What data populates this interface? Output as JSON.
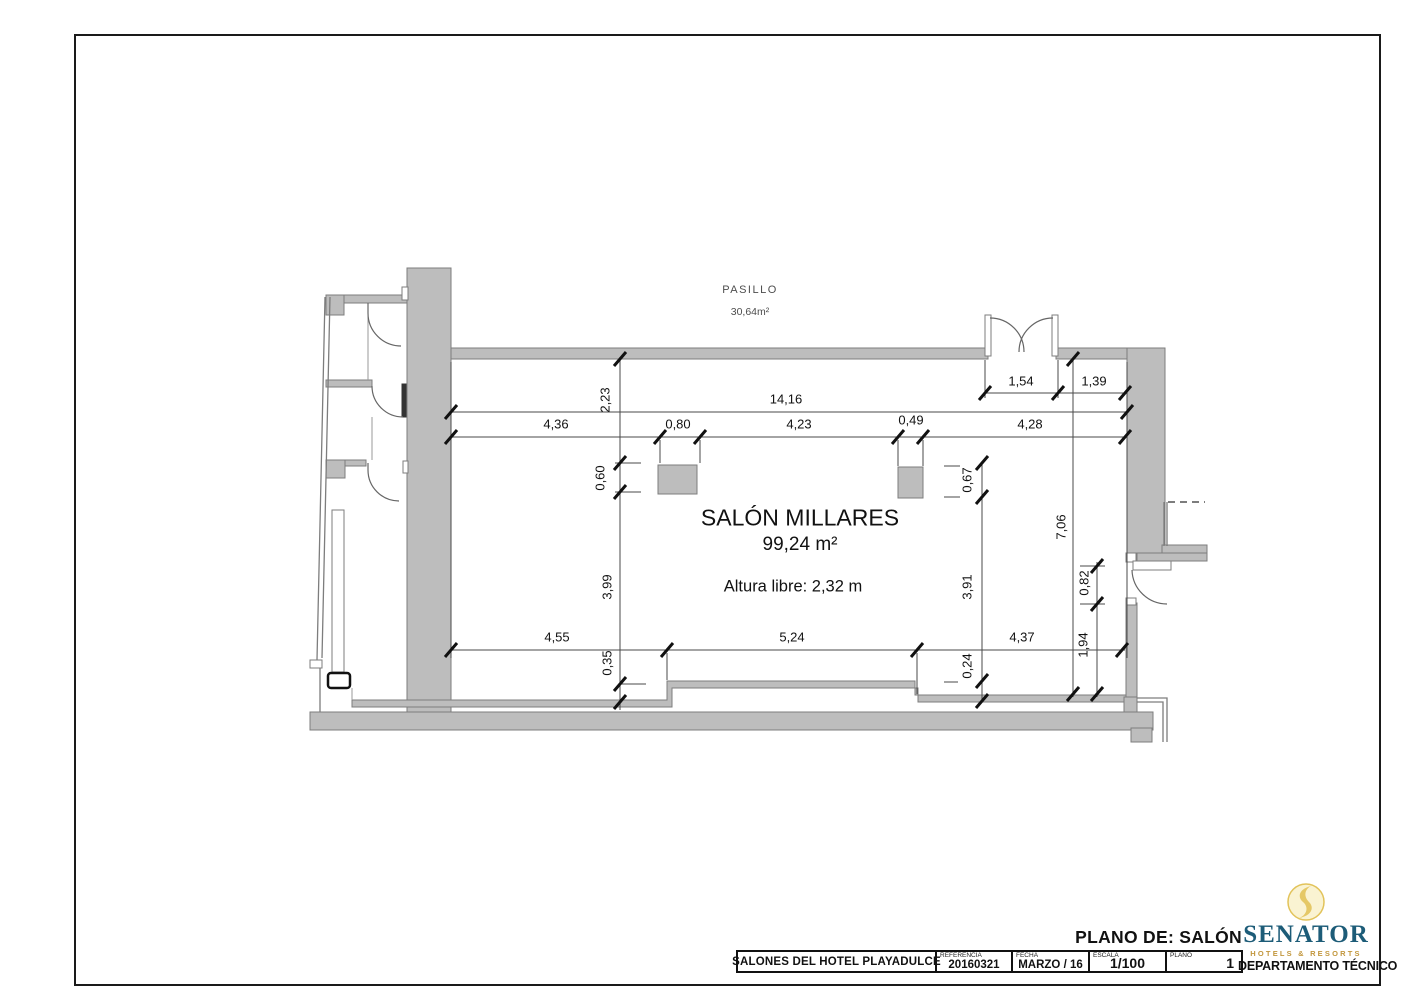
{
  "plan": {
    "corridor": {
      "label": "PASILLO",
      "area": "30,64m²"
    },
    "room": {
      "name": "SALÓN MILLARES",
      "area": "99,24 m²",
      "clear_height": "Altura libre: 2,32 m"
    },
    "dims": {
      "top_overall": "14,16",
      "top_door": "1,54",
      "top_door_right": "1,39",
      "top_left_seg": "4,36",
      "col_left_w": "0,80",
      "top_mid_seg": "4,23",
      "col_right_w": "0,49",
      "top_right_seg": "4,28",
      "left_offset": "2,23",
      "col_left_h": "0,60",
      "col_right_h": "0,67",
      "left_inner": "3,99",
      "right_inner": "3,91",
      "right_overall": "7,06",
      "right_door": "0,82",
      "right_door_offset": "1,94",
      "bottom_left_seg": "4,55",
      "bottom_mid_seg": "5,24",
      "bottom_right_seg": "4,37",
      "step_left": "0,35",
      "step_right": "0,24"
    }
  },
  "title_block": {
    "plan_of": "PLANO DE: SALÓN MILLARES",
    "project": "SALONES DEL HOTEL PLAYADULCE",
    "reference_label": "REFERENCIA",
    "reference_value": "20160321",
    "date_label": "FECHA",
    "date_value": "MARZO / 16",
    "scale_label": "ESCALA",
    "scale_value": "1/100",
    "sheet_label": "PLANO",
    "sheet_value": "1"
  },
  "logo": {
    "name": "SENATOR",
    "tagline": "HOTELS & RESORTS",
    "department": "DEPARTAMENTO TÉCNICO"
  },
  "colors": {
    "wall_fill": "#bdbdbd",
    "wall_edge": "#7d7d7d",
    "dim_line": "#4a4a4a",
    "tick": "#111111",
    "brand_teal": "#1d5c78",
    "brand_gold": "#c2973d",
    "logo_yellow": "#e2c35a",
    "logo_yellow_light": "#faf3d2"
  }
}
